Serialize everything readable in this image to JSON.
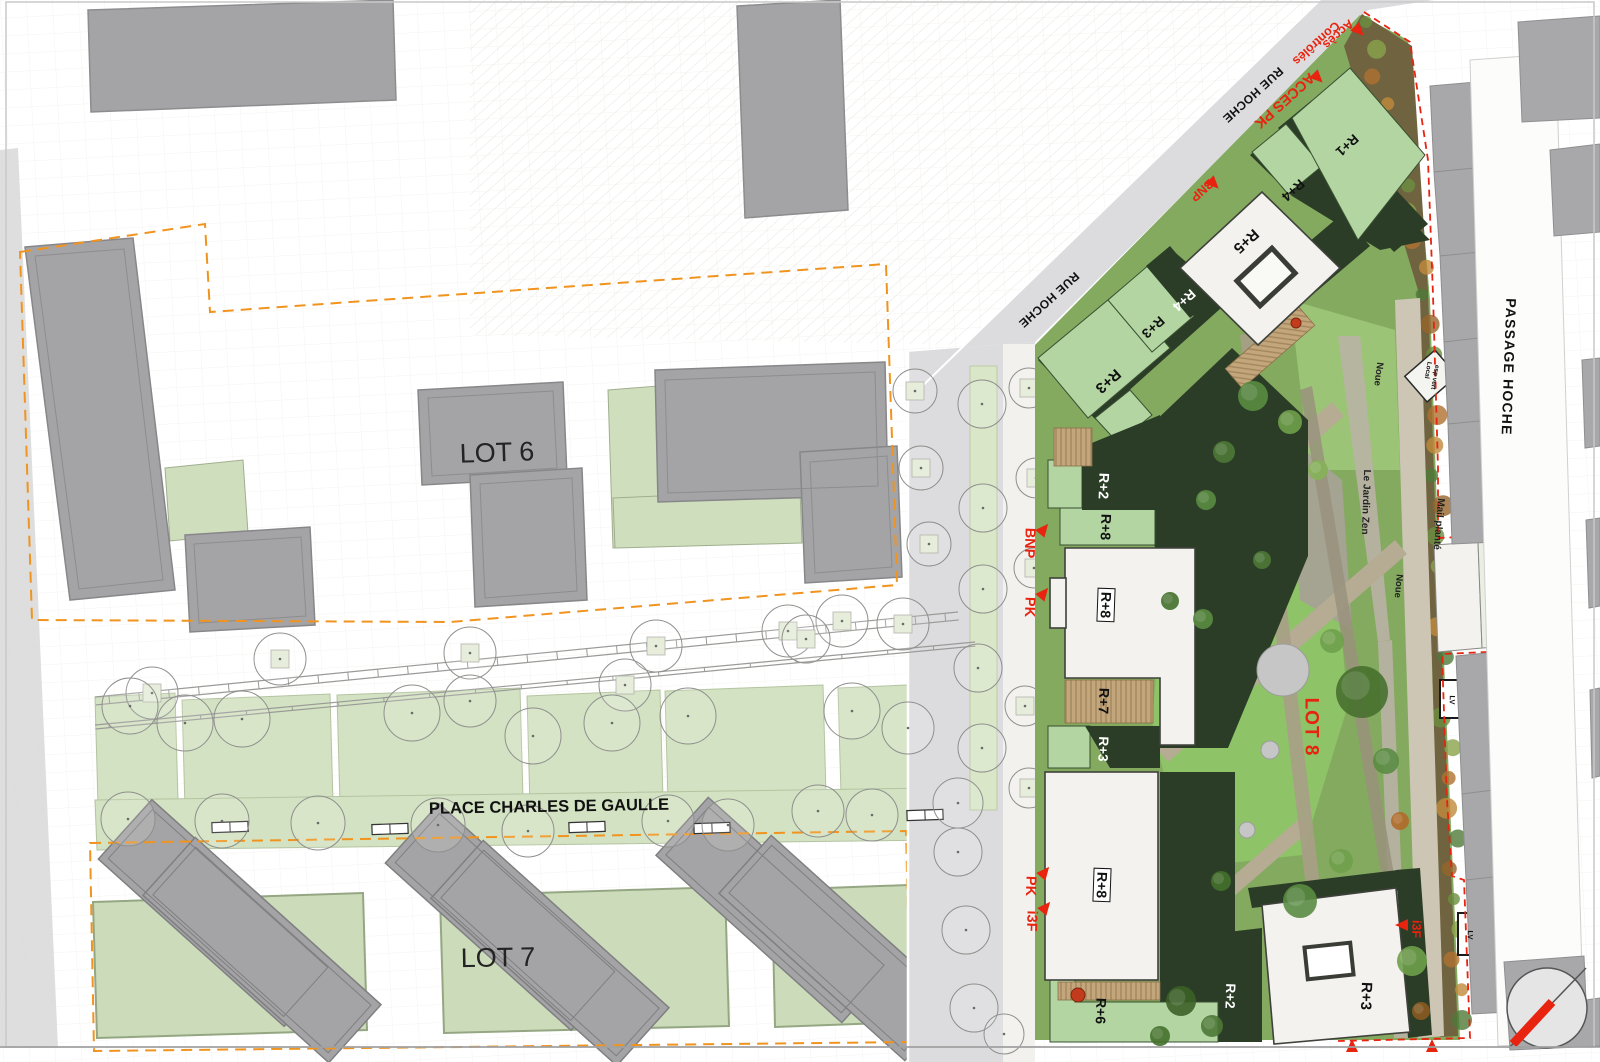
{
  "document": {
    "type": "architectural masterplan site plan"
  },
  "colors": {
    "accent_red": "#e8230f",
    "boundary_orange": "#f0941f",
    "context_gray": "#a8a8aa",
    "roof_dark_green": "#2b3d27",
    "roof_light_green": "#b2d5a2",
    "lawn_green": "#8ec368",
    "white_building": "#f3f2ee"
  },
  "icons": {
    "access_arrow_icon": "red solid triangle",
    "north_arrow_icon": "circle with diagonal red needle"
  },
  "labels": {
    "lots": [
      {
        "text": "LOT 6",
        "x": 497,
        "y": 453,
        "size": 27,
        "rot": -2,
        "color": "#232323",
        "weight": 400
      },
      {
        "text": "LOT 7",
        "x": 498,
        "y": 958,
        "size": 27,
        "rot": -1,
        "color": "#232323",
        "weight": 400
      },
      {
        "text": "LOT 8",
        "x": 1311,
        "y": 727,
        "size": 19,
        "rot": 90,
        "color": "#e8230f",
        "weight": 700,
        "ls": 1
      }
    ],
    "streets": [
      {
        "text": "PLACE CHARLES DE GAULLE",
        "x": 549,
        "y": 807,
        "size": 16.5,
        "rot": -1,
        "color": "#111111",
        "weight": 700
      },
      {
        "text": "RUE HOCHE",
        "x": 1253,
        "y": 95,
        "size": 12,
        "rot": 138,
        "color": "#111111",
        "weight": 600,
        "ls": 0.5
      },
      {
        "text": "RUE HOCHE",
        "x": 1049,
        "y": 300,
        "size": 12,
        "rot": 138,
        "color": "#111111",
        "weight": 600,
        "ls": 0.5
      },
      {
        "text": "PASSAGE HOCHE",
        "x": 1509,
        "y": 367,
        "size": 14,
        "rot": 92,
        "color": "#111111",
        "weight": 700,
        "ls": 1.2
      }
    ],
    "access": [
      {
        "text": "Accès",
        "x": 1338,
        "y": 34,
        "size": 12.5,
        "rot": 138,
        "color": "#e8230f",
        "weight": 700
      },
      {
        "text": "Contrôlés",
        "x": 1316,
        "y": 43,
        "size": 12.5,
        "rot": 138,
        "color": "#e8230f",
        "weight": 700
      },
      {
        "text": "ACCES PK",
        "x": 1284,
        "y": 100,
        "size": 14.5,
        "rot": 138,
        "color": "#e8230f",
        "weight": 700
      },
      {
        "text": "BNP",
        "x": 1202,
        "y": 190,
        "size": 12.5,
        "rot": 138,
        "color": "#e8230f",
        "weight": 700
      },
      {
        "text": "BNP",
        "x": 1029,
        "y": 543,
        "size": 14.5,
        "rot": 92,
        "color": "#e8230f",
        "weight": 700
      },
      {
        "text": "PK",
        "x": 1029,
        "y": 607,
        "size": 14.5,
        "rot": 92,
        "color": "#e8230f",
        "weight": 700
      },
      {
        "text": "PK",
        "x": 1030,
        "y": 886,
        "size": 14.5,
        "rot": 92,
        "color": "#e8230f",
        "weight": 700
      },
      {
        "text": "i3F",
        "x": 1031,
        "y": 921,
        "size": 14.5,
        "rot": 92,
        "color": "#e8230f",
        "weight": 700
      },
      {
        "text": "i3F",
        "x": 1416,
        "y": 929,
        "size": 12.5,
        "rot": 92,
        "color": "#e8230f",
        "weight": 700
      }
    ],
    "buildings": [
      {
        "text": "R+1",
        "x": 1347,
        "y": 145,
        "size": 13.5,
        "rot": 138,
        "color": "#111111",
        "weight": 700
      },
      {
        "text": "R+4",
        "x": 1293,
        "y": 190,
        "size": 13.5,
        "rot": 138,
        "color": "#111111",
        "weight": 700
      },
      {
        "text": "R+5",
        "x": 1246,
        "y": 241,
        "size": 15,
        "rot": 138,
        "color": "#111111",
        "weight": 700
      },
      {
        "text": "R+4",
        "x": 1184,
        "y": 300,
        "size": 13.5,
        "rot": 138,
        "color": "#ffffff",
        "weight": 700
      },
      {
        "text": "R+3",
        "x": 1153,
        "y": 327,
        "size": 13.5,
        "rot": 138,
        "color": "#111111",
        "weight": 700
      },
      {
        "text": "R+3",
        "x": 1108,
        "y": 381,
        "size": 15,
        "rot": 138,
        "color": "#111111",
        "weight": 700
      },
      {
        "text": "R+2",
        "x": 1104,
        "y": 486,
        "size": 14,
        "rot": 92,
        "color": "#ffffff",
        "weight": 700
      },
      {
        "text": "R+8",
        "x": 1106,
        "y": 527,
        "size": 14,
        "rot": 92,
        "color": "#111111",
        "weight": 700
      },
      {
        "text": "R+8",
        "x": 1106,
        "y": 605,
        "size": 14,
        "rot": 92,
        "color": "#111111",
        "weight": 700,
        "boxed": true
      },
      {
        "text": "R+7",
        "x": 1104,
        "y": 701,
        "size": 14,
        "rot": 92,
        "color": "#111111",
        "weight": 700
      },
      {
        "text": "R+3",
        "x": 1103,
        "y": 749,
        "size": 13.5,
        "rot": 92,
        "color": "#ffffff",
        "weight": 700
      },
      {
        "text": "R+8",
        "x": 1102,
        "y": 885,
        "size": 14,
        "rot": 92,
        "color": "#111111",
        "weight": 700,
        "boxed": true
      },
      {
        "text": "R+6",
        "x": 1101,
        "y": 1011,
        "size": 14,
        "rot": 92,
        "color": "#111111",
        "weight": 700
      },
      {
        "text": "R+2",
        "x": 1230,
        "y": 996,
        "size": 13.5,
        "rot": 92,
        "color": "#ffffff",
        "weight": 700
      },
      {
        "text": "R+3",
        "x": 1366,
        "y": 996,
        "size": 15,
        "rot": 92,
        "color": "#111111",
        "weight": 700
      }
    ],
    "landscape": [
      {
        "text": "Noue",
        "x": 1378,
        "y": 374,
        "size": 9.5,
        "rot": 97,
        "color": "#222222",
        "weight": 600
      },
      {
        "text": "Le Jardin Zen",
        "x": 1365,
        "y": 502,
        "size": 10,
        "rot": 92,
        "color": "#222222",
        "weight": 600
      },
      {
        "text": "Noue",
        "x": 1398,
        "y": 586,
        "size": 9.5,
        "rot": 95,
        "color": "#222222",
        "weight": 600
      },
      {
        "text": "Mail planté",
        "x": 1438,
        "y": 524,
        "size": 10,
        "rot": 95,
        "color": "#222222",
        "weight": 600
      },
      {
        "text": "Local",
        "x": 1427,
        "y": 370,
        "size": 6.5,
        "rot": 100,
        "color": "#111111",
        "weight": 700
      },
      {
        "text": "esp vert",
        "x": 1434,
        "y": 377,
        "size": 6.5,
        "rot": 100,
        "color": "#111111",
        "weight": 700
      },
      {
        "text": "LV",
        "x": 1452,
        "y": 700,
        "size": 7.5,
        "rot": 92,
        "color": "#111111",
        "weight": 700
      },
      {
        "text": "LV",
        "x": 1470,
        "y": 935,
        "size": 7.5,
        "rot": 92,
        "color": "#111111",
        "weight": 700
      }
    ]
  }
}
